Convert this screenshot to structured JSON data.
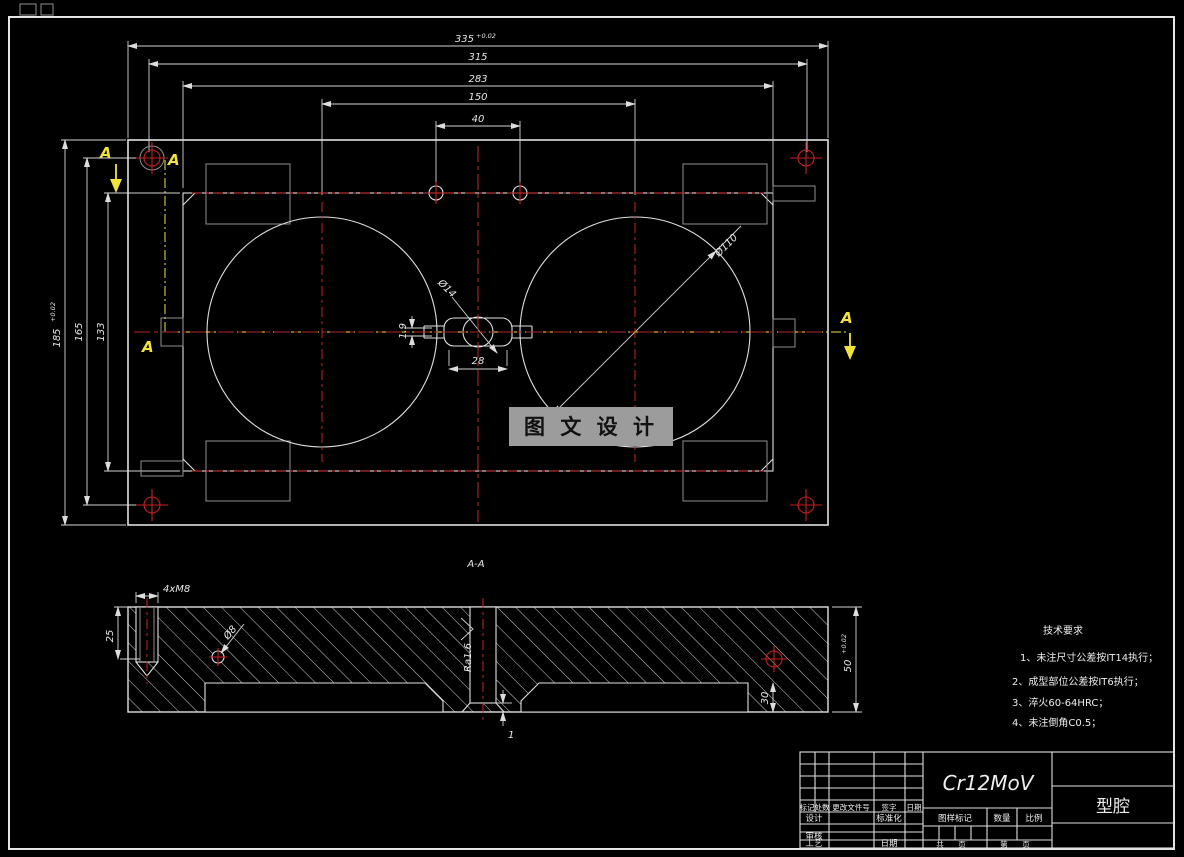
{
  "watermark": {
    "text": "图 文 设 计"
  },
  "section_label": "A-A",
  "view_labels": {
    "a": "A"
  },
  "dimensions": {
    "d335": "335",
    "d335_tol": "+0.02",
    "d315": "315",
    "d283": "283",
    "d150": "150",
    "d40": "40",
    "d185": "185",
    "d185_tol": "+0.02",
    "d165": "165",
    "d133": "133",
    "d28": "28",
    "d1_9": "1.9",
    "d14": "Ø14",
    "d110": "Ø110",
    "m8": "4xM8",
    "d8": "Ø8",
    "ra": "Ra1.6",
    "d25": "25",
    "d50": "50",
    "d50_tol": "+0.02",
    "d30": "30",
    "d1": "1"
  },
  "tech_requirements": {
    "title": "技术要求",
    "line1": "1、未注尺寸公差按IT14执行；",
    "line2": "2、成型部位公差按IT6执行；",
    "line3": "3、淬火60-64HRC；",
    "line4": "4、未注倒角C0.5；"
  },
  "title_block": {
    "material": "Cr12MoV",
    "part_name": "型腔",
    "mark": "标记",
    "count": "处数",
    "change_doc": "更改文件号",
    "sign": "签字",
    "date": "日期",
    "design": "设计",
    "standardize": "标准化",
    "review": "审核",
    "process": "工艺",
    "date2": "日期",
    "drawing_mark": "图样标记",
    "quantity": "数量",
    "scale": "比例",
    "total": "共",
    "page": "页",
    "no": "第",
    "page2": "页"
  },
  "colors": {
    "line": "#e0e0e0",
    "red": "#c82020",
    "yellow": "#f2e23c",
    "gray": "#8f8f8f",
    "watermark_bg": "#9c9c9c"
  }
}
